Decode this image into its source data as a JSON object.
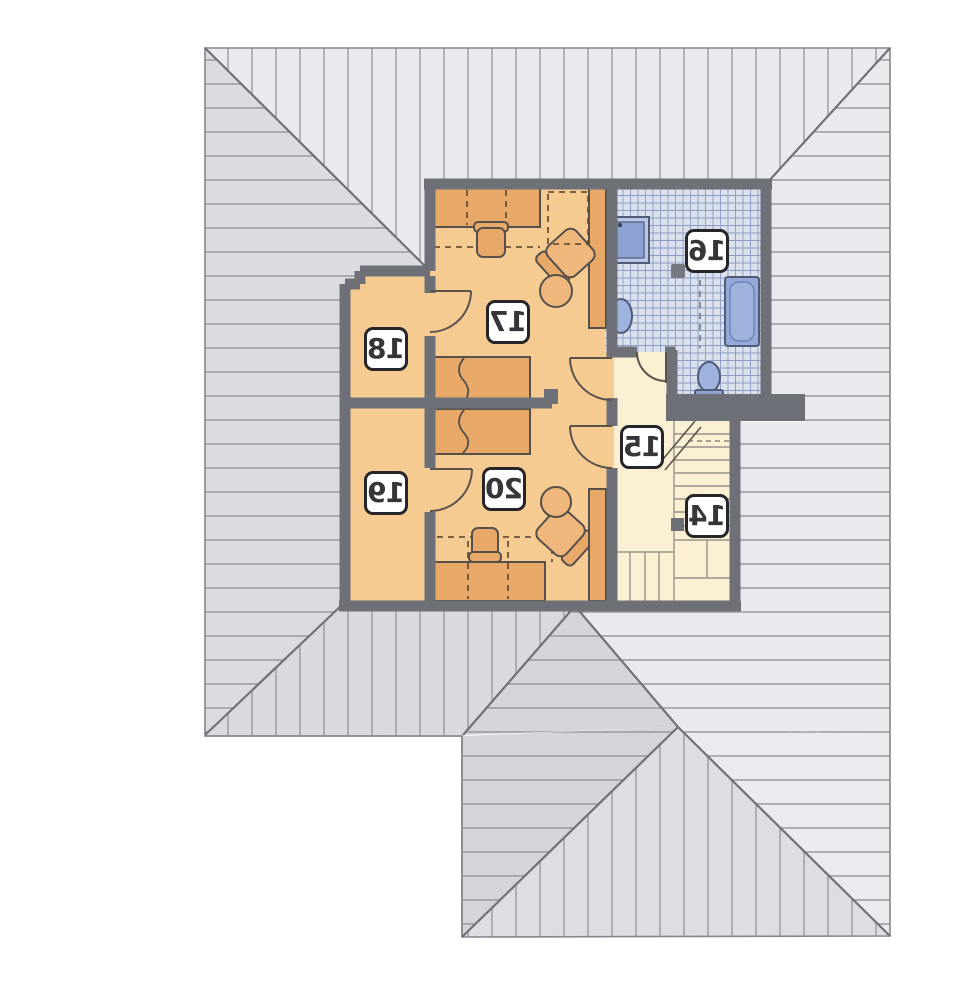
{
  "plan": {
    "kind": "attic floor plan (mirrored print)",
    "rooms": [
      {
        "number": "14",
        "type": "staircase"
      },
      {
        "number": "15",
        "type": "hallway"
      },
      {
        "number": "16",
        "type": "bathroom"
      },
      {
        "number": "17",
        "type": "bedroom"
      },
      {
        "number": "18",
        "type": "room"
      },
      {
        "number": "19",
        "type": "room"
      },
      {
        "number": "20",
        "type": "bedroom"
      }
    ],
    "fixtures": [
      "shower",
      "washbasin",
      "bathtub",
      "toilet",
      "bed",
      "bed",
      "desk",
      "desk",
      "stool",
      "stool",
      "armchair",
      "armchair",
      "round-table",
      "round-table",
      "wardrobe",
      "wardrobe",
      "staircase"
    ],
    "colors": {
      "wall": "#6d7076",
      "room_fill": "#f6cb92",
      "furniture_fill": "#e8a868",
      "hall_fill": "#fbf0d3",
      "tile_floor": "#dbe0ed",
      "tile_line": "#8d9cc4",
      "fixture_blue": "#9db2dc",
      "roof_light": "#e8eaed",
      "roof_dark": "#d8dade",
      "label_bg": "#ffffff",
      "label_border": "#26262a"
    }
  }
}
